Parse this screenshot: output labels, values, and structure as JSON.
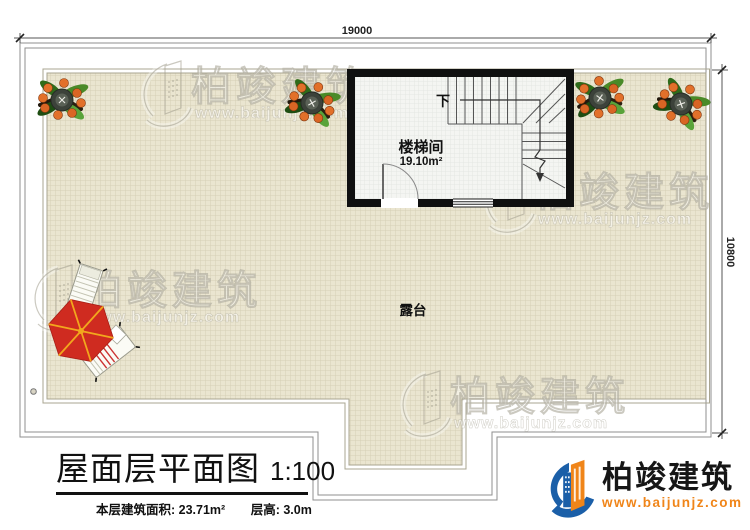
{
  "drawing": {
    "dimensions": {
      "top": "19000",
      "right": "10800"
    },
    "rooms": {
      "stair_room": {
        "name": "楼梯间",
        "area": "19.10m²",
        "direction": "下"
      },
      "terrace": {
        "name": "露台"
      }
    }
  },
  "title_block": {
    "title": "屋面层平面图",
    "scale": "1:100",
    "floor_area": "本层建筑面积: 23.71m²",
    "floor_height": "层高: 3.0m"
  },
  "branding": {
    "logo_name": "柏竣建筑",
    "logo_url": "www.baijunjz.com",
    "watermark_name": "柏竣建筑",
    "watermark_url": "www.baijunjz.com"
  },
  "colors": {
    "wall": "#101010",
    "terrace_tile": "#eae5d0",
    "tile_grid": "#d5d0b6",
    "stair_floor": "#f4f5f2",
    "umbrella_red": "#cf2b20",
    "umbrella_ribs": "#f2a71d",
    "logo_blue": "#1b5fa8",
    "logo_orange": "#f08519"
  }
}
